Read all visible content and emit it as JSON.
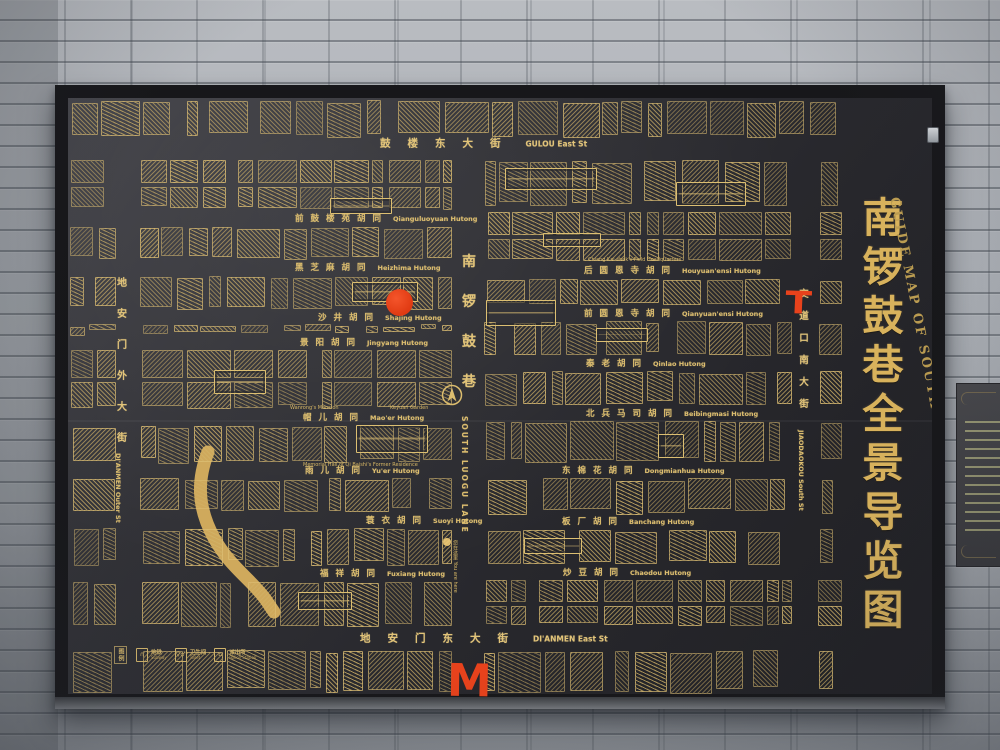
{
  "sign": {
    "title_cn": "南锣鼓巷全景导览图",
    "title_en": "GUIDE MAP OF SOUTH LUOGU LANE",
    "streets": {
      "top": {
        "cn": "鼓楼东大街",
        "en": "GULOU East St"
      },
      "bottom": {
        "cn": "地安门东大街",
        "en": "DI'ANMEN East St"
      },
      "left": {
        "cn": "地安门外大街",
        "en": "DI'ANMEN Outer St"
      },
      "right": {
        "cn": "交道口南大街",
        "en": "JIAODAOKOU South St"
      },
      "center": {
        "cn": "南锣鼓巷",
        "en": "SOUTH LUOGU LANE"
      }
    },
    "hutongs_west": [
      {
        "cn": "前鼓楼苑胡同",
        "en": "Qianguluoyuan Hutong",
        "x": 295,
        "y": 218
      },
      {
        "cn": "黑芝麻胡同",
        "en": "Heizhima Hutong",
        "x": 295,
        "y": 267
      },
      {
        "cn": "沙井胡同",
        "en": "Shajing Hutong",
        "x": 318,
        "y": 317
      },
      {
        "cn": "景阳胡同",
        "en": "Jingyang Hutong",
        "x": 300,
        "y": 342
      },
      {
        "cn": "帽儿胡同",
        "en": "Mao'er Hutong",
        "x": 303,
        "y": 417
      },
      {
        "cn": "雨儿胡同",
        "en": "Yu'er Hutong",
        "x": 305,
        "y": 470
      },
      {
        "cn": "蓑衣胡同",
        "en": "Suoyi Hutong",
        "x": 366,
        "y": 520
      },
      {
        "cn": "福祥胡同",
        "en": "Fuxiang Hutong",
        "x": 320,
        "y": 573
      }
    ],
    "hutongs_east": [
      {
        "cn": "后圆恩寺胡同",
        "en": "Houyuan'ensi Hutong",
        "x": 584,
        "y": 270
      },
      {
        "cn": "前圆恩寺胡同",
        "en": "Qianyuan'ensi Hutong",
        "x": 584,
        "y": 313
      },
      {
        "cn": "秦老胡同",
        "en": "Qinlao Hutong",
        "x": 586,
        "y": 363
      },
      {
        "cn": "北兵马司胡同",
        "en": "Beibingmasi Hutong",
        "x": 586,
        "y": 413
      },
      {
        "cn": "东棉花胡同",
        "en": "Dongmianhua Hutong",
        "x": 562,
        "y": 470
      },
      {
        "cn": "板厂胡同",
        "en": "Banchang Hutong",
        "x": 562,
        "y": 521
      },
      {
        "cn": "炒豆胡同",
        "en": "Chaodou Hutong",
        "x": 563,
        "y": 572
      }
    ],
    "sites": [
      {
        "en": "Chiang Kai-shek's Field Headquarters",
        "x": 588,
        "y": 257
      },
      {
        "en": "Wanrong's Mansion",
        "x": 290,
        "y": 405
      },
      {
        "en": "Keyuan Garden",
        "x": 390,
        "y": 405
      },
      {
        "en": "Memorial Hall of Qi Baishi's Former Residence",
        "x": 303,
        "y": 462
      }
    ],
    "you_are_here": {
      "cn": "您在这里",
      "en": "You are here"
    },
    "legend": {
      "title": "图例",
      "items": [
        {
          "cn": "地铁",
          "en": "Subway"
        },
        {
          "cn": "卫生间",
          "en": "Toilet"
        },
        {
          "cn": "派出所",
          "en": "Police Station"
        }
      ]
    }
  },
  "annotations": {
    "marker_color": "#e8421c",
    "dot": {
      "x": 399,
      "y": 302,
      "r": 13
    },
    "letter_t": {
      "text": "T",
      "x": 804,
      "y": 310
    },
    "letter_m": {
      "text": "M",
      "x": 470,
      "y": 684
    }
  },
  "colors": {
    "gold": "#d2b065",
    "board_dark": "#26262a",
    "frame": "#1b1b1e",
    "brick": "#aeb2b8",
    "red_marker": "#e8421c"
  }
}
